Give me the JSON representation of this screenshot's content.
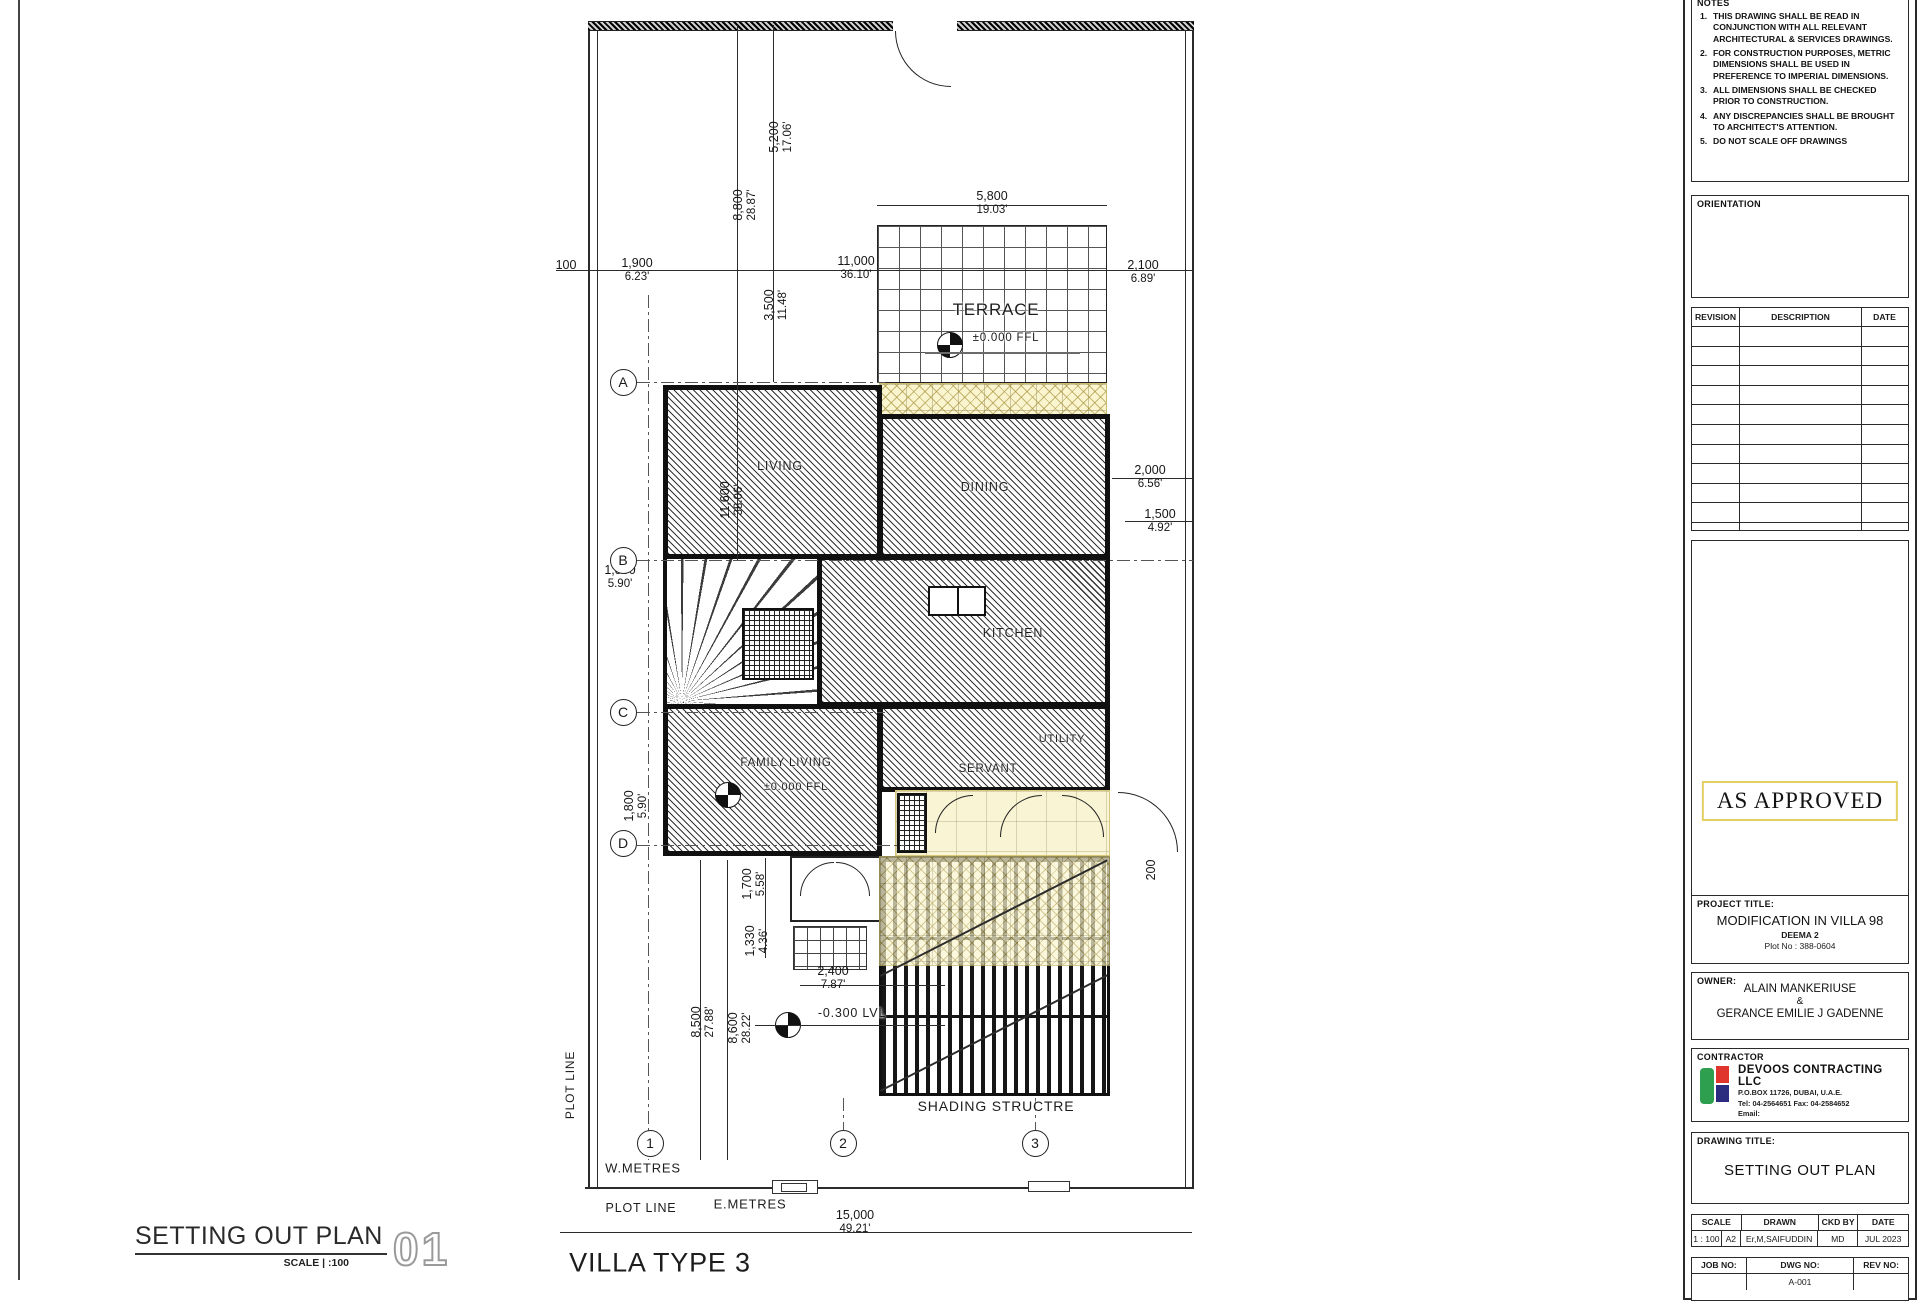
{
  "plan": {
    "bottom_title": {
      "title": "SETTING OUT PLAN",
      "scale_text": "SCALE | :100",
      "number": "01"
    },
    "dimensions": [
      {
        "m": "100",
        "ft": "",
        "x": 566,
        "y": 266,
        "rot": 0
      },
      {
        "m": "1,900",
        "ft": "6.23'",
        "x": 637,
        "y": 270,
        "rot": 0
      },
      {
        "m": "11,000",
        "ft": "36.10'",
        "x": 856,
        "y": 268,
        "rot": 0
      },
      {
        "m": "2,100",
        "ft": "6.89'",
        "x": 1143,
        "y": 272,
        "rot": 0
      },
      {
        "m": "5,800",
        "ft": "19.03'",
        "x": 992,
        "y": 203,
        "rot": 0
      },
      {
        "m": "5,200",
        "ft": "17.06'",
        "x": 781,
        "y": 137,
        "rot": -90
      },
      {
        "m": "8,800",
        "ft": "28.87'",
        "x": 745,
        "y": 205,
        "rot": -90
      },
      {
        "m": "3,500",
        "ft": "11.48'",
        "x": 776,
        "y": 305,
        "rot": -90
      },
      {
        "m": "11,600",
        "ft": "38.06'",
        "x": 732,
        "y": 500,
        "rot": -90
      },
      {
        "m": "2,000",
        "ft": "6.56'",
        "x": 1150,
        "y": 477,
        "rot": 0
      },
      {
        "m": "1,500",
        "ft": "4.92'",
        "x": 1160,
        "y": 521,
        "rot": 0
      },
      {
        "m": "1,800",
        "ft": "5.90'",
        "x": 620,
        "y": 577,
        "rot": 0
      },
      {
        "m": "1,800",
        "ft": "5.90'",
        "x": 636,
        "y": 806,
        "rot": -90
      },
      {
        "m": "1,700",
        "ft": "5.58'",
        "x": 754,
        "y": 884,
        "rot": -90
      },
      {
        "m": "1,330",
        "ft": "4.36'",
        "x": 757,
        "y": 941,
        "rot": -90
      },
      {
        "m": "8,500",
        "ft": "27.88'",
        "x": 703,
        "y": 1022,
        "rot": -90
      },
      {
        "m": "8,600",
        "ft": "28.22'",
        "x": 740,
        "y": 1028,
        "rot": -90
      },
      {
        "m": "2,400",
        "ft": "7.87'",
        "x": 833,
        "y": 978,
        "rot": 0
      },
      {
        "m": "200",
        "ft": "",
        "x": 1152,
        "y": 870,
        "rot": -90
      },
      {
        "m": "15,000",
        "ft": "49.21'",
        "x": 855,
        "y": 1222,
        "rot": 0
      }
    ],
    "labels": [
      {
        "text": "TERRACE",
        "x": 996,
        "y": 310,
        "size": 17,
        "rot": 0
      },
      {
        "text": "±0.000 FFL",
        "x": 1006,
        "y": 338,
        "size": 11.5,
        "rot": 0
      },
      {
        "text": "LIVING",
        "x": 780,
        "y": 466,
        "size": 12.5,
        "rot": 0
      },
      {
        "text": "DINING",
        "x": 985,
        "y": 487,
        "size": 12.5,
        "rot": 0
      },
      {
        "text": "KITCHEN",
        "x": 1013,
        "y": 633,
        "size": 12.5,
        "rot": 0
      },
      {
        "text": "UTILITY",
        "x": 1062,
        "y": 739,
        "size": 11,
        "rot": 0
      },
      {
        "text": "SERVANT",
        "x": 988,
        "y": 769,
        "size": 11.5,
        "rot": 0
      },
      {
        "text": "FAMILY LIVING",
        "x": 786,
        "y": 763,
        "size": 11.5,
        "rot": 0
      },
      {
        "text": "±0.000 FFL",
        "x": 796,
        "y": 787,
        "size": 11,
        "rot": 0
      },
      {
        "text": "-0.300 LVL",
        "x": 852,
        "y": 1013,
        "size": 12.5,
        "rot": 0
      },
      {
        "text": "SHADING STRUCTRE",
        "x": 996,
        "y": 1106,
        "size": 14,
        "rot": 0
      },
      {
        "text": "PLOT LINE",
        "x": 570,
        "y": 1085,
        "size": 12,
        "rot": -90
      },
      {
        "text": "PLOT LINE",
        "x": 641,
        "y": 1208,
        "size": 12.5,
        "rot": 0
      },
      {
        "text": "W.METRES",
        "x": 643,
        "y": 1168,
        "size": 13,
        "rot": 0
      },
      {
        "text": "E.METRES",
        "x": 750,
        "y": 1204,
        "size": 13,
        "rot": 0
      },
      {
        "text": "VILLA TYPE 3",
        "x": 660,
        "y": 1263,
        "size": 27,
        "rot": 0
      }
    ],
    "grid_bubbles": [
      {
        "label": "A",
        "x": 623,
        "y": 382
      },
      {
        "label": "B",
        "x": 623,
        "y": 560
      },
      {
        "label": "C",
        "x": 623,
        "y": 712
      },
      {
        "label": "D",
        "x": 623,
        "y": 843
      },
      {
        "label": "1",
        "x": 650,
        "y": 1143
      },
      {
        "label": "2",
        "x": 843,
        "y": 1143
      },
      {
        "label": "3",
        "x": 1035,
        "y": 1143
      }
    ]
  },
  "titleblock": {
    "notes": {
      "title": "NOTES",
      "items": [
        "THIS DRAWING SHALL BE READ IN CONJUNCTION WITH ALL RELEVANT ARCHITECTURAL & SERVICES DRAWINGS.",
        "FOR CONSTRUCTION PURPOSES, METRIC DIMENSIONS SHALL BE USED IN PREFERENCE TO IMPERIAL DIMENSIONS.",
        "ALL DIMENSIONS SHALL BE CHECKED PRIOR TO CONSTRUCTION.",
        "ANY DISCREPANCIES SHALL BE BROUGHT TO ARCHITECT'S ATTENTION.",
        "DO NOT SCALE OFF DRAWINGS"
      ]
    },
    "orientation_label": "ORIENTATION",
    "revision_table": {
      "headers": [
        "REVISION",
        "DESCRIPTION",
        "DATE"
      ],
      "empty_rows": 11
    },
    "stamp": "AS APPROVED",
    "project": {
      "label": "PROJECT  TITLE:",
      "title": "MODIFICATION IN VILLA 98",
      "line2": "DEEMA 2",
      "line3": "Plot No : 388-0604"
    },
    "owner": {
      "label": "OWNER:",
      "line1": "ALAIN MANKERIUSE",
      "amp": "&",
      "line2": "GERANCE EMILIE J GADENNE"
    },
    "contractor": {
      "label": "CONTRACTOR",
      "name": "DEVOOS CONTRACTING LLC",
      "address": "P.O.BOX 11726,  DUBAI, U.A.E.",
      "tel": "Tel: 04-2564651  Fax: 04-2584652",
      "email": "Email: info@devoos.com/devoosbm@gmail.com"
    },
    "drawing": {
      "label": "DRAWING  TITLE:",
      "title": "SETTING OUT PLAN"
    },
    "meta": {
      "h_scale": "SCALE",
      "h_drawn": "DRAWN",
      "h_ckd": "CKD  BY",
      "h_date": "DATE",
      "scale": "1 : 100",
      "size": "A2",
      "drawn": "Er,M,SAIFUDDIN",
      "ckd": "MD",
      "date": "JUL 2023"
    },
    "meta2": {
      "h_job": "JOB  NO:",
      "h_dwg": "DWG  NO:",
      "h_rev": "REV  NO:",
      "dwg_no": "A-001"
    },
    "brand_colors": {
      "green": "#2e9e4f",
      "red": "#df352c",
      "navy": "#2b2b80",
      "stamp_border": "#e3cf63"
    }
  }
}
